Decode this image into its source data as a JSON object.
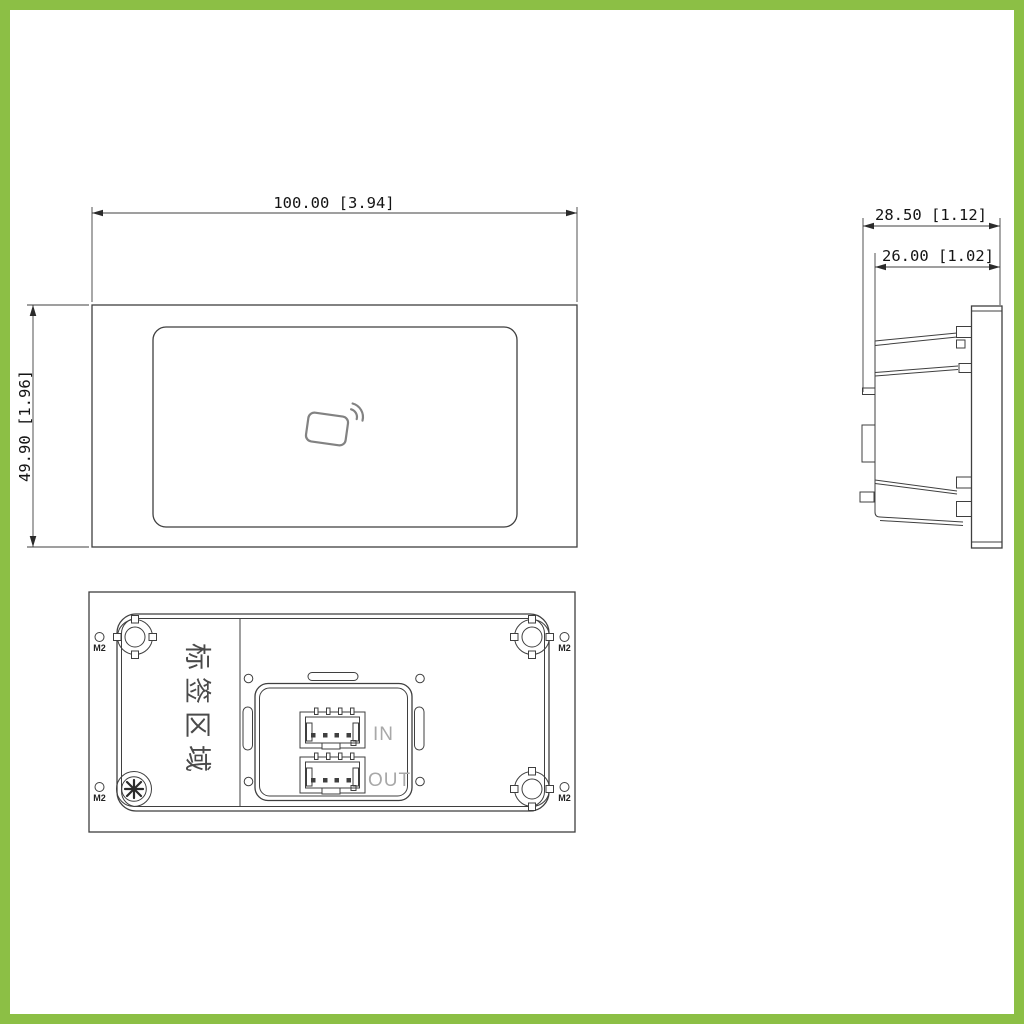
{
  "page": {
    "type": "product dimension drawing",
    "frame_color": "#8CBF45",
    "background": "#ffffff"
  },
  "views": {
    "front": {
      "name": "front-view",
      "width_dim": "100.00 [3.94]",
      "height_dim": "49.90 [1.96]",
      "icon": "contactless-card-icon"
    },
    "side": {
      "name": "side-view",
      "depth_overall_dim": "28.50 [1.12]",
      "depth_body_dim": "26.00 [1.02]"
    },
    "rear": {
      "name": "rear-view",
      "label_area_text": "标签区域",
      "connector_in_label": "IN",
      "connector_out_label": "OUT",
      "screw_hole_labels": [
        "M2",
        "M2",
        "M2",
        "M2"
      ]
    }
  },
  "colors": {
    "line": "#3f3f3f",
    "muted_label": "#a8a8a8",
    "icon_gray": "#828282"
  }
}
